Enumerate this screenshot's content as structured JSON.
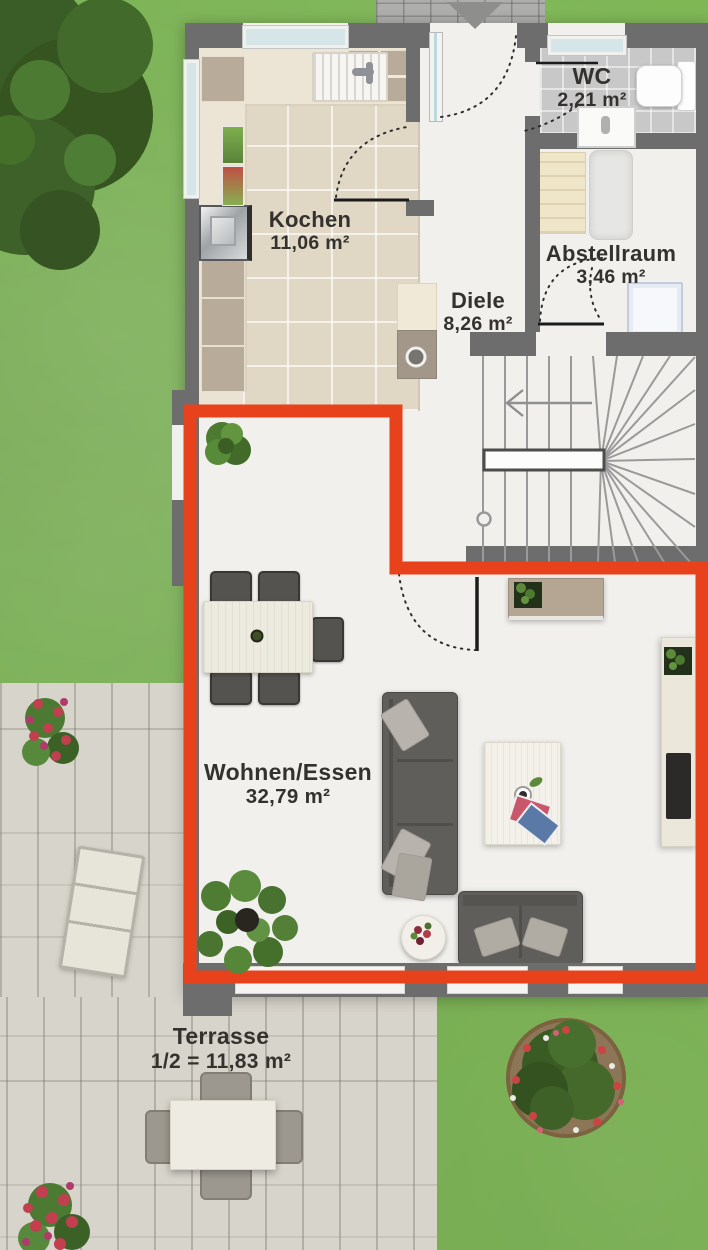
{
  "rooms": [
    {
      "id": "kochen",
      "name": "Kochen",
      "area": "11,06 m²"
    },
    {
      "id": "wc",
      "name": "WC",
      "area": "2,21 m²"
    },
    {
      "id": "abstellraum",
      "name": "Abstellraum",
      "area": "3,46 m²"
    },
    {
      "id": "diele",
      "name": "Diele",
      "area": "8,26 m²"
    },
    {
      "id": "wohnen_essen",
      "name": "Wohnen/Essen",
      "area": "32,79 m²"
    },
    {
      "id": "terrasse",
      "name": "Terrasse",
      "area": "1/2 = 11,83 m²"
    }
  ],
  "colors": {
    "highlight": "#e8421c",
    "wall": "#6d6d6d",
    "grass": "#75b14a",
    "kitchen_tile": "#e0d7c5",
    "wc_tile": "#c8c8c8",
    "terrace_plank": "#d7d4cb"
  }
}
